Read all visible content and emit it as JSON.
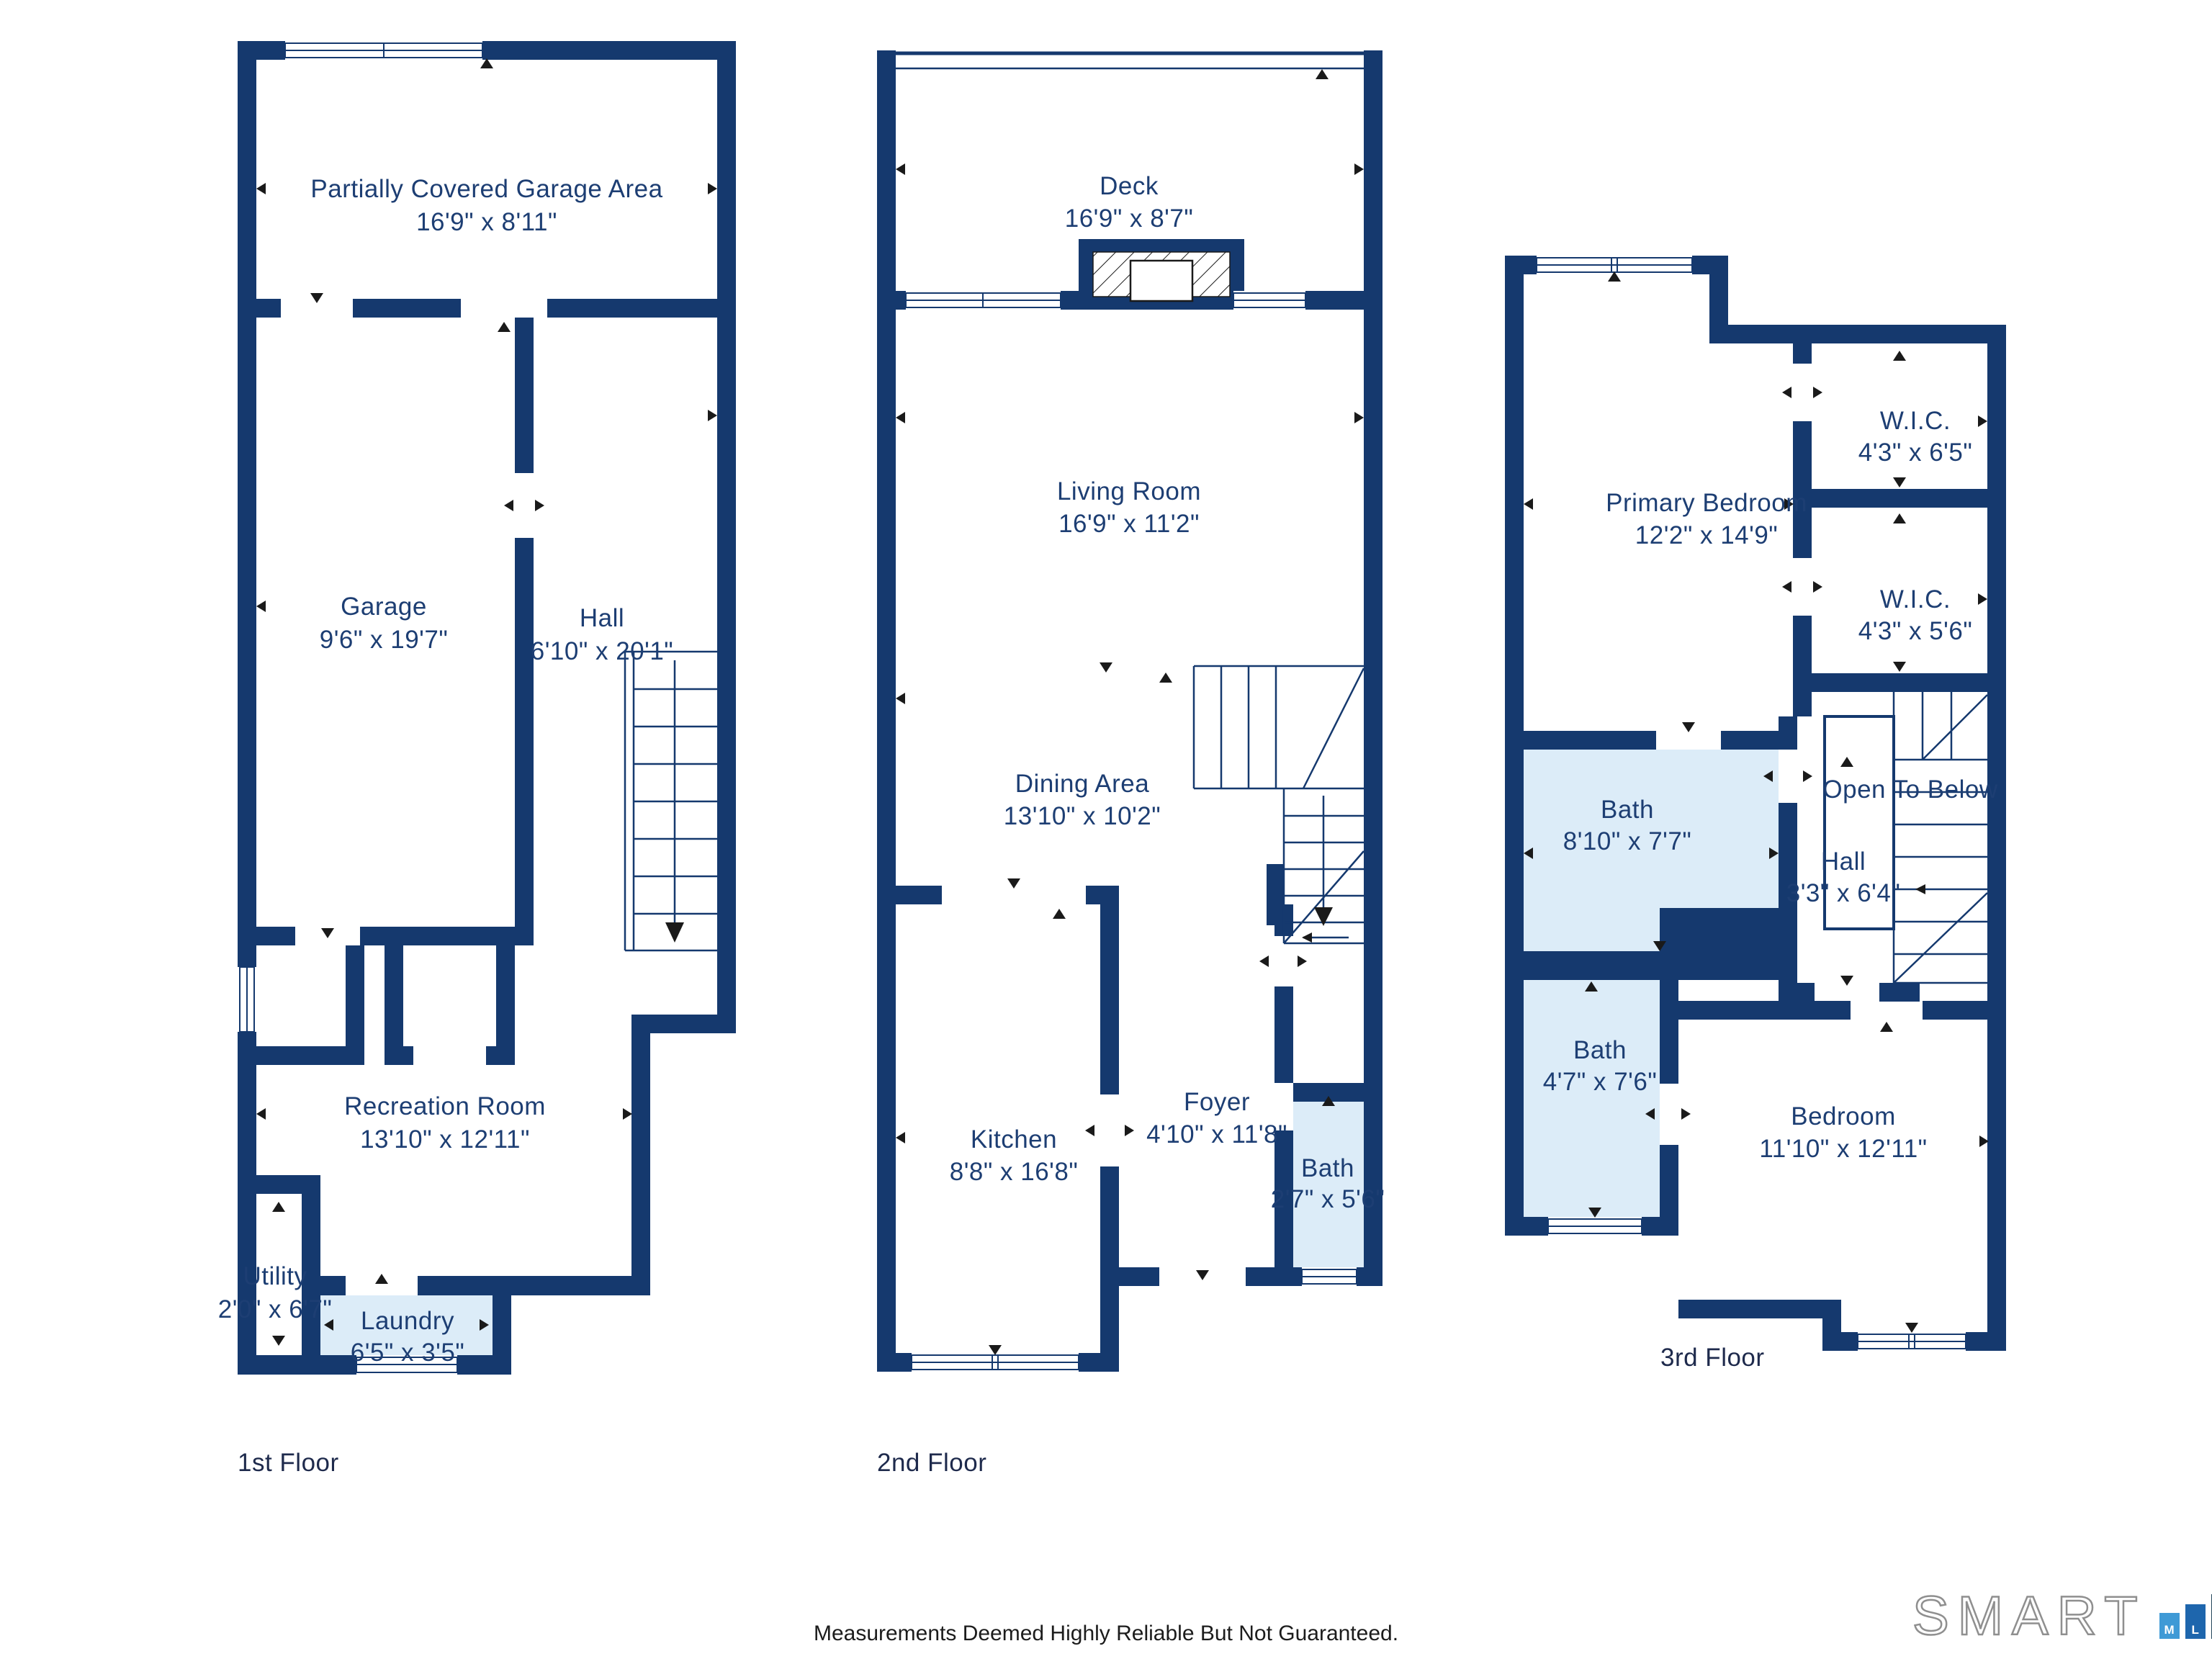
{
  "floors": [
    {
      "label": "1st Floor",
      "rooms": [
        {
          "id": "partially-covered-garage-area",
          "name": "Partially Covered Garage Area",
          "dims": "16'9\" x 8'11\""
        },
        {
          "id": "garage",
          "name": "Garage",
          "dims": "9'6\" x 19'7\""
        },
        {
          "id": "hall",
          "name": "Hall",
          "dims": "6'10\" x 20'1\""
        },
        {
          "id": "recreation-room",
          "name": "Recreation Room",
          "dims": "13'10\" x 12'11\""
        },
        {
          "id": "utility",
          "name": "Utility",
          "dims": "2'0\" x 6'7\""
        },
        {
          "id": "laundry",
          "name": "Laundry",
          "dims": "6'5\" x 3'5\""
        }
      ]
    },
    {
      "label": "2nd Floor",
      "rooms": [
        {
          "id": "deck",
          "name": "Deck",
          "dims": "16'9\" x 8'7\""
        },
        {
          "id": "living-room",
          "name": "Living Room",
          "dims": "16'9\" x 11'2\""
        },
        {
          "id": "dining-area",
          "name": "Dining Area",
          "dims": "13'10\" x 10'2\""
        },
        {
          "id": "kitchen",
          "name": "Kitchen",
          "dims": "8'8\" x 16'8\""
        },
        {
          "id": "foyer",
          "name": "Foyer",
          "dims": "4'10\" x 11'8\""
        },
        {
          "id": "bath",
          "name": "Bath",
          "dims": "2'7\" x 5'6\""
        }
      ]
    },
    {
      "label": "3rd Floor",
      "rooms": [
        {
          "id": "primary-bedroom",
          "name": "Primary Bedroom",
          "dims": "12'2\" x 14'9\""
        },
        {
          "id": "wic-upper",
          "name": "W.I.C.",
          "dims": "4'3\" x 6'5\""
        },
        {
          "id": "wic-lower",
          "name": "W.I.C.",
          "dims": "4'3\" x 5'6\""
        },
        {
          "id": "bath-upper",
          "name": "Bath",
          "dims": "8'10\" x 7'7\""
        },
        {
          "id": "open-to-below",
          "name": "Open To Below",
          "dims": ""
        },
        {
          "id": "hall",
          "name": "Hall",
          "dims": "3'3\" x 6'4\""
        },
        {
          "id": "bath-lower",
          "name": "Bath",
          "dims": "4'7\" x 7'6\""
        },
        {
          "id": "bedroom",
          "name": "Bedroom",
          "dims": "11'10\" x 12'11\""
        }
      ]
    }
  ],
  "footer": {
    "disclaimer": "Measurements Deemed Highly Reliable But Not Guaranteed."
  },
  "logo": {
    "word": "SMART",
    "mls": [
      "M",
      "L",
      "S"
    ]
  },
  "colors": {
    "wall": "#15396E",
    "room_text": "#1D3E73",
    "bath_fill": "#DCECF8",
    "logo_m": "#3F9AD6",
    "logo_l": "#1E66AD",
    "logo_s": "#25475C"
  }
}
